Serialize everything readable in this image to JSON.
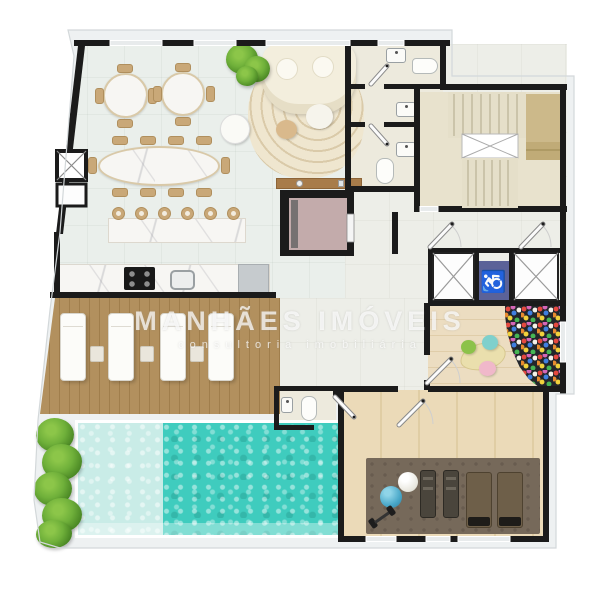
{
  "watermark": {
    "line1": "MANHÃES IMÓVEIS",
    "line2": "consultoria imobiliária"
  },
  "icons": {
    "wheelchair_glyph": "♿",
    "wheelchair_meaning": "accessible-elevator-symbol",
    "shaft_cross": "X"
  },
  "palette": {
    "wall": "#1b1b1b",
    "slab": "#eef1f2",
    "tile_main": "#eaefeb",
    "tile_hall": "#edeee8",
    "floor_wc": "#edeadd",
    "floor_stair": "#e8e2cd",
    "stair_tan": "#ccb98a",
    "marble": "#f7f6f3",
    "chair_wood": "#c9a878",
    "sofa_cream": "#f3eedd",
    "rug_beige": "#efe6cf",
    "elevator_pink": "#c3abab",
    "accessible_blue": "#5b6298",
    "deck_wood": "#b2905e",
    "pool_shallow": "#c9ece7",
    "pool_deep": "#3fccbe",
    "plant_green": "#6fb03a",
    "play_wood": "#ecddc1",
    "gym_wood": "#ebdab8",
    "gym_mat": "#76695a",
    "ballpit_bg": "#23262b"
  },
  "zones": [
    "dining-lounge",
    "kitchen",
    "bar-counter",
    "powder-rooms",
    "stairwell",
    "elevator-lobby",
    "elevator-bank",
    "private-elevator",
    "kids-playroom",
    "ball-pit",
    "gym",
    "sun-deck",
    "swimming-pool",
    "pool-wc",
    "planter-strip"
  ],
  "counts": {
    "round_dining_tables": 2,
    "round_table_chairs_each": 4,
    "oval_table_chairs": 10,
    "bar_stools": 6,
    "sun_loungers": 4,
    "deck_side_tables": 3,
    "elevator_shafts": 2,
    "toilets": 4,
    "wash_basins": 5,
    "gym_benches": 2,
    "gym_machines": 2,
    "exercise_balls": 2,
    "play_poufs": 3
  }
}
